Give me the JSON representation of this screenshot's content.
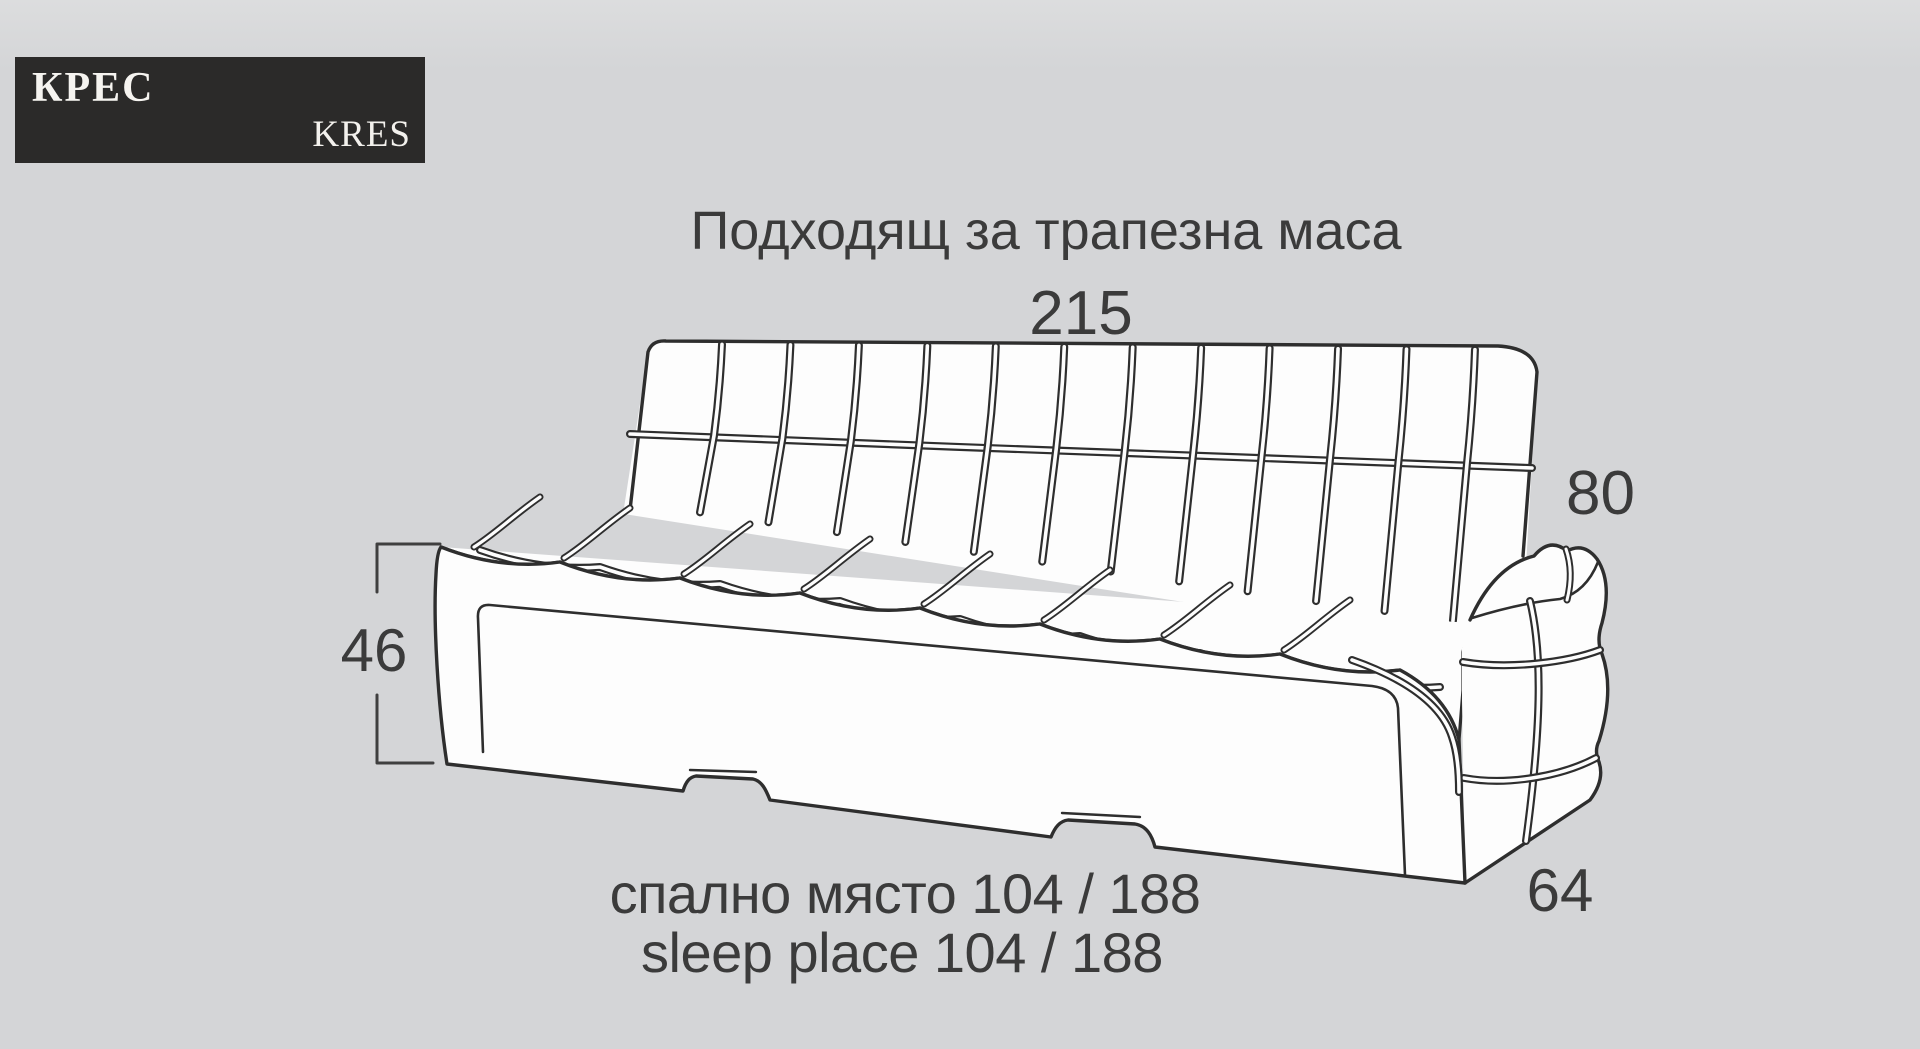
{
  "logo": {
    "primary": "КРЕС",
    "secondary": "KRES"
  },
  "title": "Подходящ за трапезна маса",
  "dimensions": {
    "width": "215",
    "back_height": "80",
    "seat_height": "46",
    "depth": "64"
  },
  "captions": {
    "sleep_place_bg": "спално място 104 / 188",
    "sleep_place_en": "sleep place 104 / 188"
  },
  "drawing": {
    "description": "kitchen-sofa-line-drawing",
    "colors": {
      "background": "#d4d5d7",
      "line": "#2e2e2e",
      "fill": "#fdfdfd",
      "text": "#3b3b3b",
      "logo_background": "#2b2a29",
      "logo_text": "#f6f4f0"
    }
  }
}
